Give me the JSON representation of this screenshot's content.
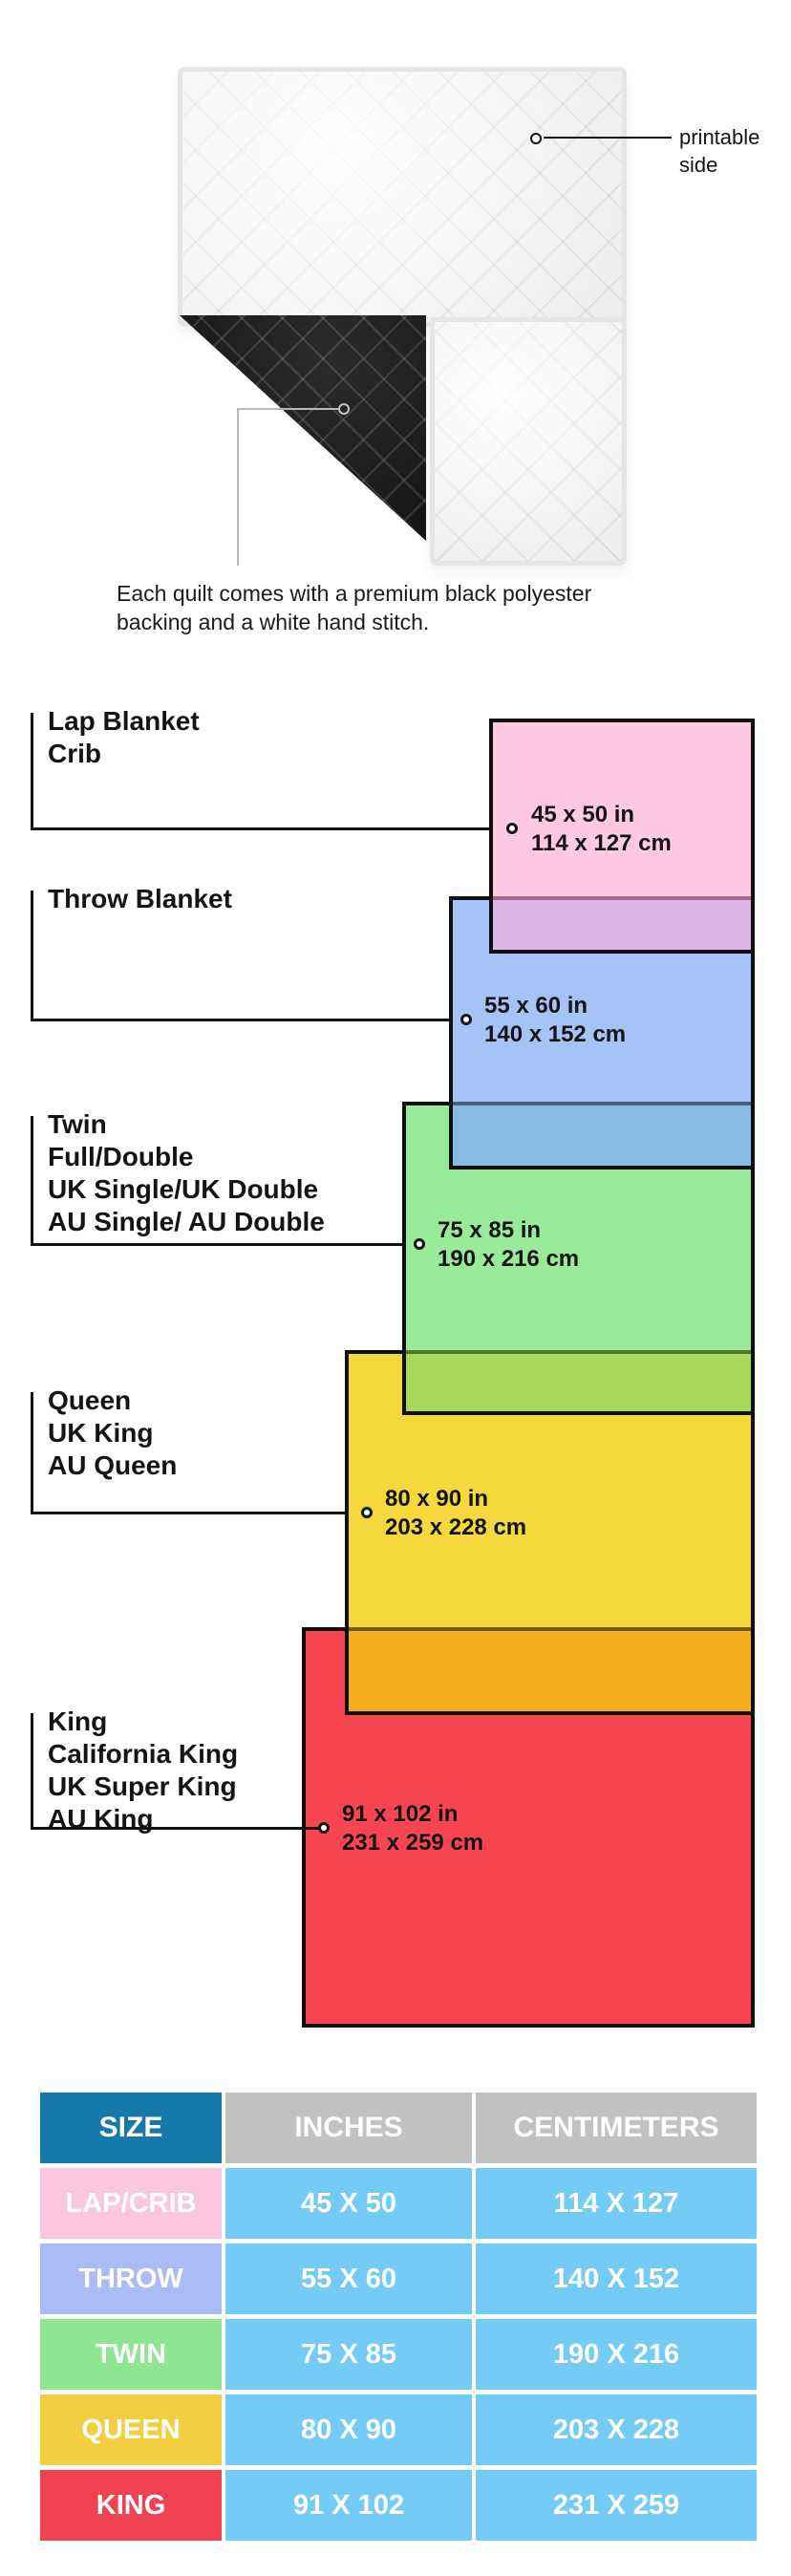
{
  "hero": {
    "printable_line1": "printable",
    "printable_line2": "side",
    "caption_line1": "Each quilt comes with a premium black polyester",
    "caption_line2": "backing and a white hand stitch."
  },
  "diagram": {
    "sizes": [
      {
        "id": "lap",
        "labels": [
          "Lap Blanket",
          "Crib"
        ],
        "inches": "45 x 50 in",
        "cm": "114 x 127 cm",
        "color": "#FFC9E3",
        "overlap_color": "#DDB5E6"
      },
      {
        "id": "throw",
        "labels": [
          "Throw Blanket"
        ],
        "inches": "55 x 60 in",
        "cm": "140 x 152 cm",
        "color": "#A6C3F7",
        "overlap_color": "#88BBE3"
      },
      {
        "id": "twin",
        "labels": [
          "Twin",
          "Full/Double",
          "UK Single/UK Double",
          "AU Single/ AU Double"
        ],
        "inches": "75 x 85 in",
        "cm": "190 x 216 cm",
        "color": "#99EB99",
        "overlap_color": "#A9D95A"
      },
      {
        "id": "queen",
        "labels": [
          "Queen",
          "UK King",
          "AU Queen"
        ],
        "inches": "80 x 90 in",
        "cm": "203 x 228 cm",
        "color": "#F5D73E",
        "overlap_color": "#F5AF1E"
      },
      {
        "id": "king",
        "labels": [
          "King",
          "California King",
          "UK Super King",
          "AU King"
        ],
        "inches": "91 x 102 in",
        "cm": "231 x 259 cm",
        "color": "#F74652",
        "overlap_color": ""
      }
    ]
  },
  "table": {
    "headers": [
      "SIZE",
      "INCHES",
      "CENTIMETERS"
    ],
    "header_size_color": "#1679A8",
    "header_grey_color": "#C2C2C2",
    "value_cell_color": "#74CCF4",
    "rows": [
      {
        "size": "LAP/CRIB",
        "inches": "45 X 50",
        "cm": "114 X 127",
        "color": "#FAC7DE"
      },
      {
        "size": "THROW",
        "inches": "55 X 60",
        "cm": "140 X 152",
        "color": "#A9BCF5"
      },
      {
        "size": "TWIN",
        "inches": "75 X 85",
        "cm": "190 X 216",
        "color": "#90E690"
      },
      {
        "size": "QUEEN",
        "inches": "80 X 90",
        "cm": "203 X 228",
        "color": "#F2CE40"
      },
      {
        "size": "KING",
        "inches": "91 X 102",
        "cm": "231 X 259",
        "color": "#EF4351"
      }
    ]
  },
  "chart_data": {
    "type": "table",
    "title": "Quilt size comparison",
    "categories": [
      "LAP/CRIB",
      "THROW",
      "TWIN",
      "QUEEN",
      "KING"
    ],
    "series": [
      {
        "name": "width_in",
        "values": [
          45,
          55,
          75,
          80,
          91
        ]
      },
      {
        "name": "length_in",
        "values": [
          50,
          60,
          85,
          90,
          102
        ]
      },
      {
        "name": "width_cm",
        "values": [
          114,
          140,
          190,
          203,
          231
        ]
      },
      {
        "name": "length_cm",
        "values": [
          127,
          152,
          216,
          228,
          259
        ]
      }
    ]
  }
}
